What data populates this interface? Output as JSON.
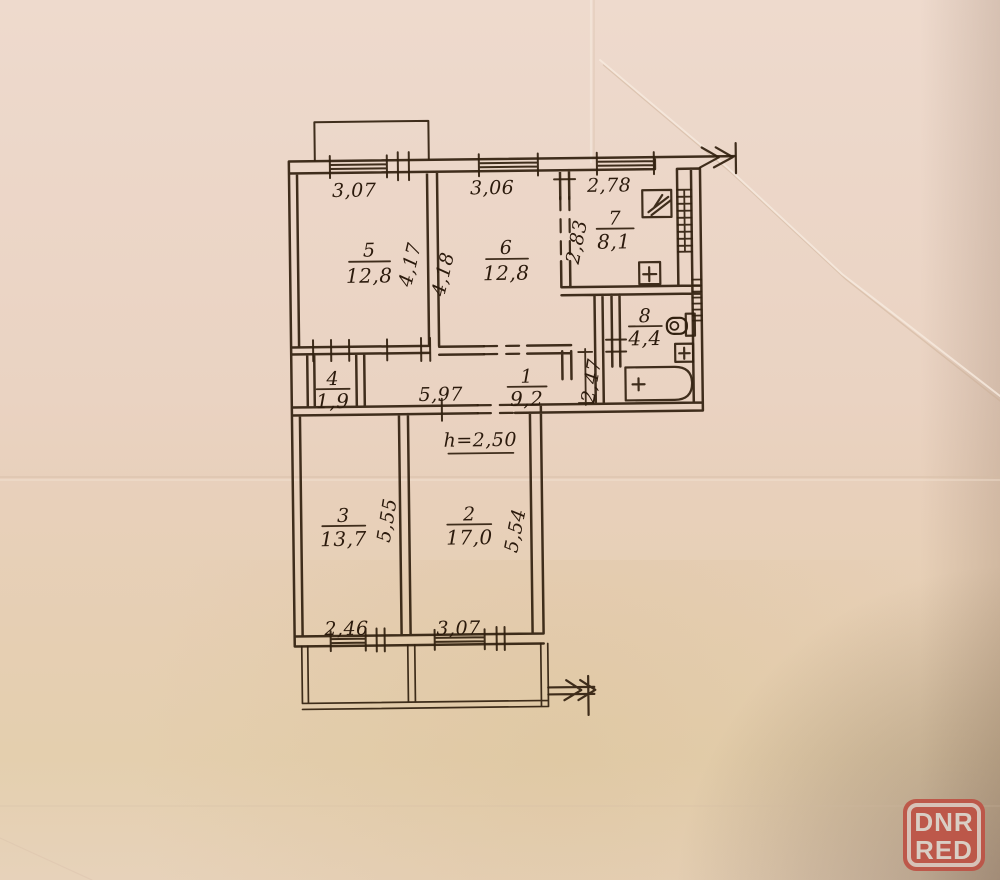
{
  "plan": {
    "rooms": [
      {
        "number": "1",
        "area": "9,2"
      },
      {
        "number": "2",
        "area": "17,0"
      },
      {
        "number": "3",
        "area": "13,7"
      },
      {
        "number": "4",
        "area": "1,9"
      },
      {
        "number": "5",
        "area": "12,8"
      },
      {
        "number": "6",
        "area": "12,8"
      },
      {
        "number": "7",
        "area": "8,1"
      },
      {
        "number": "8",
        "area": "4,4"
      }
    ],
    "dims": {
      "top_room5": "3,07",
      "top_room6": "3,06",
      "top_kitchen": "2,78",
      "side_room5": "4,17",
      "side_room6": "4,18",
      "side_kitchen": "2,83",
      "hall_width": "5,97",
      "corridor": "2,47",
      "side_room3": "5,55",
      "side_room2": "5,54",
      "bottom_room3": "2,46",
      "bottom_room2": "3,07"
    },
    "height_note": "h=2,50"
  },
  "watermark": {
    "line1": "DNR",
    "line2": "RED"
  },
  "colors": {
    "ink": "#31200f",
    "paper": "#e9d3c2",
    "badge_red": "#bd5144",
    "badge_text": "#d9cec4"
  }
}
